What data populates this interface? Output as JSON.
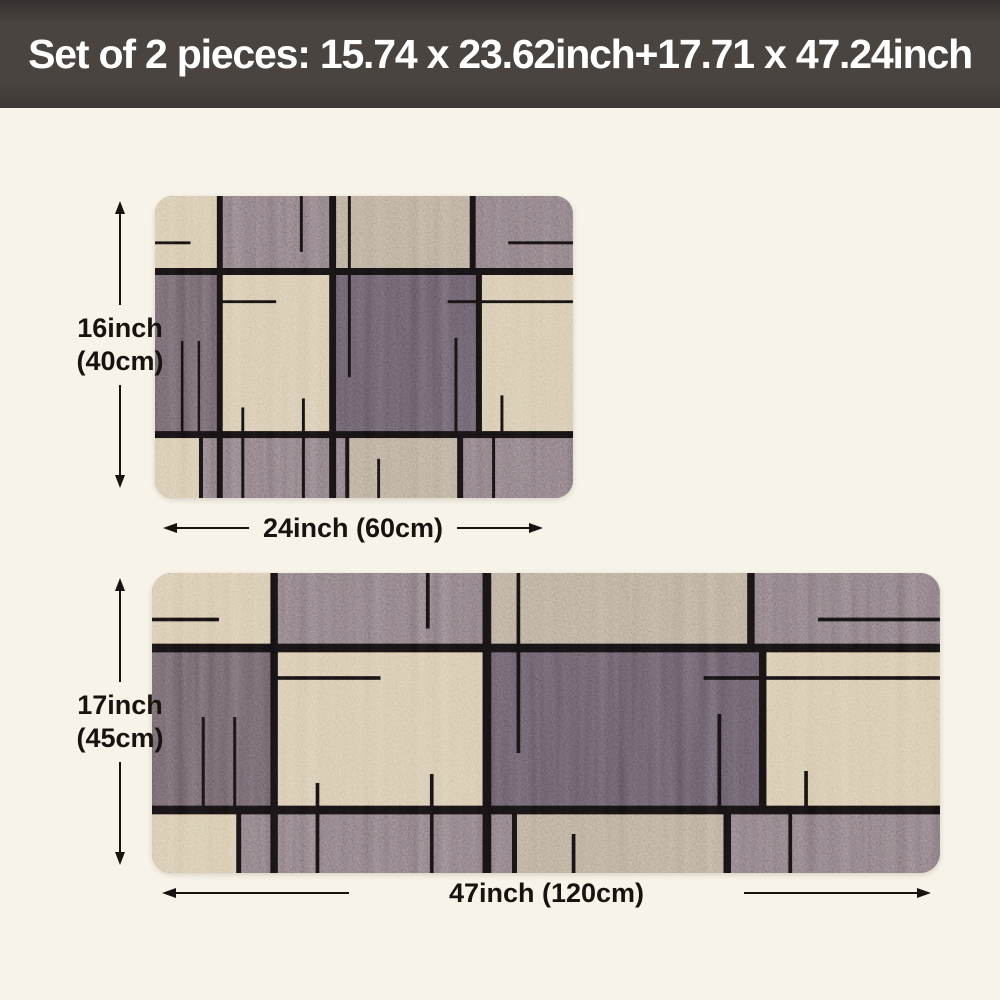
{
  "page": {
    "background": "#f8f3e8"
  },
  "banner": {
    "text": "Set of 2 pieces: 15.74 x 23.62inch+17.71 x 47.24inch",
    "background": "#4a4440",
    "text_color": "#ffffff"
  },
  "rugs": [
    {
      "id": "small",
      "height_label": [
        "16inch",
        "(40cm)"
      ],
      "width_label": "24inch (60cm)"
    },
    {
      "id": "large",
      "height_label": [
        "17inch",
        "(45cm)"
      ],
      "width_label": "47inch (120cm)"
    }
  ],
  "rug_colors": {
    "beige": "#c9b795",
    "tan": "#a3937c",
    "gray": "#6c6166",
    "dark": "#564b52",
    "dark_center": "#4f4550",
    "line": "#0d0a0b"
  },
  "annotation_color": "#17130f"
}
